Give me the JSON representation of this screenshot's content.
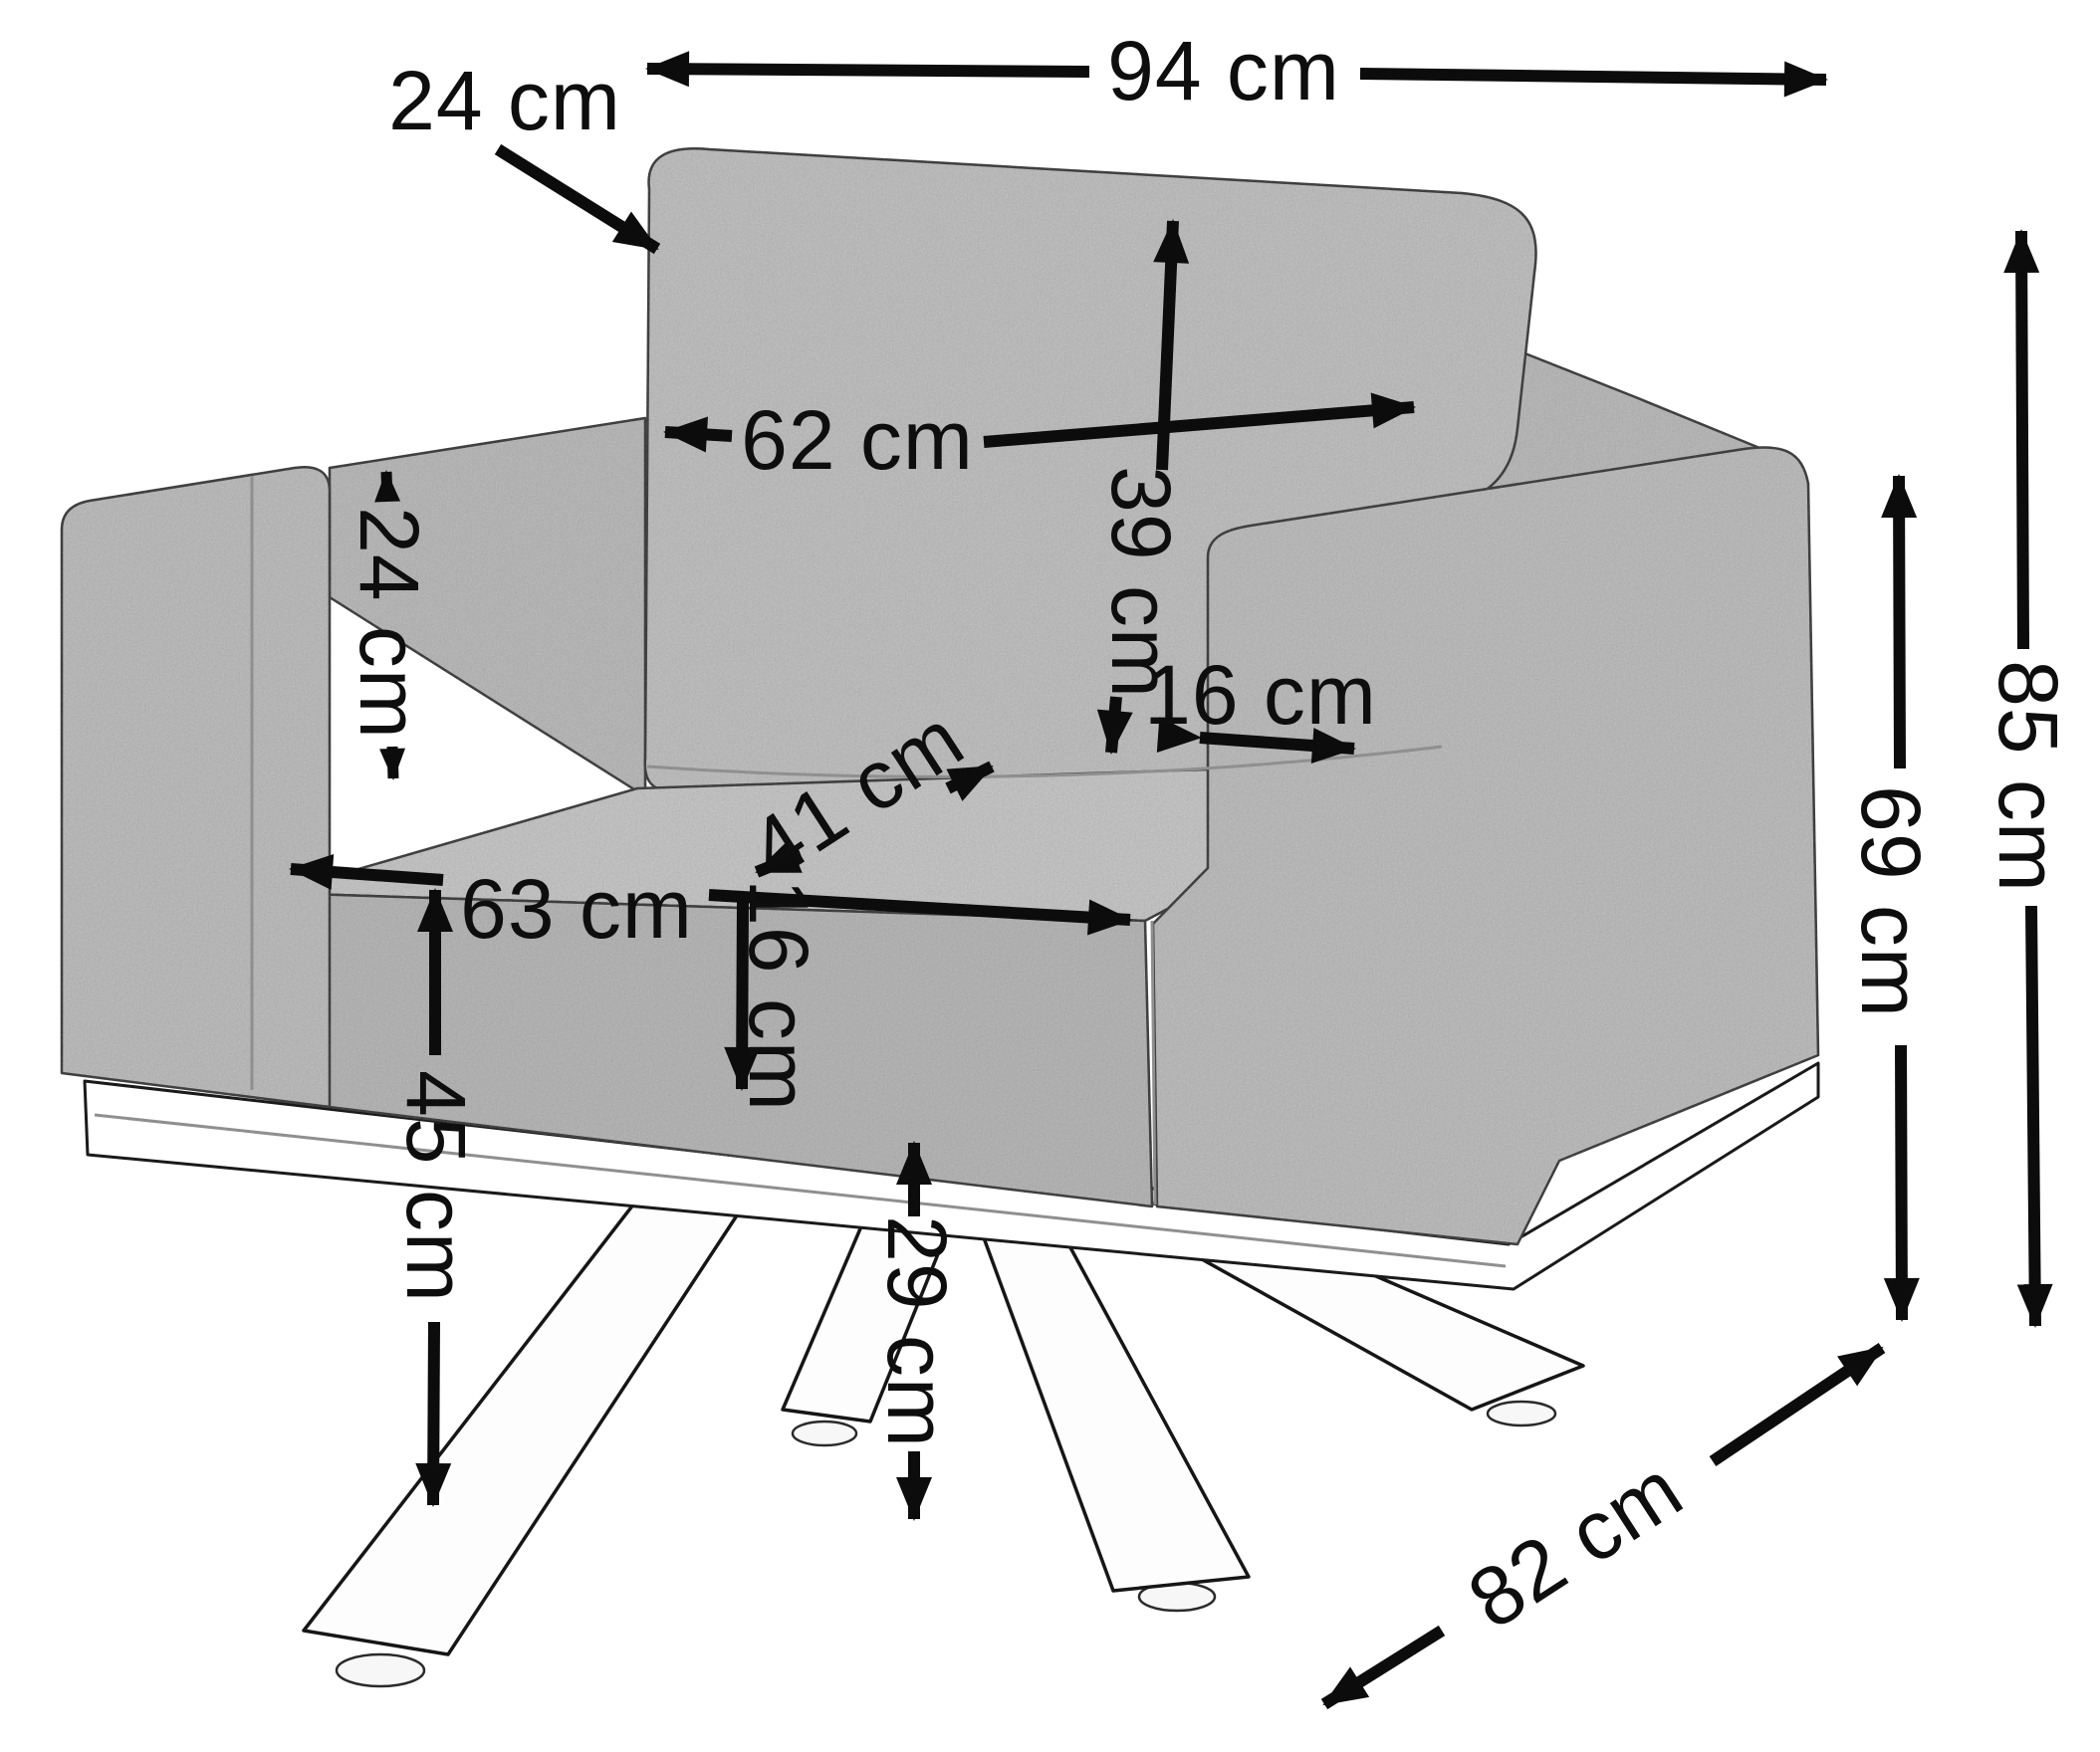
{
  "diagram": {
    "type": "furniture-dimension-diagram",
    "subject": "armchair with cushions on metal cross base",
    "unit": "cm",
    "ink_color": "#0c0c0c",
    "fabric_color": "#c3c3c3",
    "background_color": "#ffffff",
    "dims": {
      "overall_width": {
        "label": "94 cm",
        "value": 94,
        "orientation": "horizontal"
      },
      "back_cushion_thickness": {
        "label": "24 cm",
        "value": 24,
        "orientation": "diagonal-callout"
      },
      "back_cushion_width": {
        "label": "62 cm",
        "value": 62,
        "orientation": "horizontal"
      },
      "back_cushion_height": {
        "label": "39 cm",
        "value": 39,
        "orientation": "vertical"
      },
      "armrest_above_seat": {
        "label": "24 cm",
        "value": 24,
        "orientation": "vertical"
      },
      "armrest_width": {
        "label": "16 cm",
        "value": 16,
        "orientation": "horizontal"
      },
      "seat_depth": {
        "label": "41 cm",
        "value": 41,
        "orientation": "diagonal"
      },
      "seat_width": {
        "label": "63 cm",
        "value": 63,
        "orientation": "horizontal"
      },
      "seat_cushion_thickness": {
        "label": "16 cm",
        "value": 16,
        "orientation": "vertical"
      },
      "seat_height": {
        "label": "45 cm",
        "value": 45,
        "orientation": "vertical"
      },
      "base_clearance": {
        "label": "29 cm",
        "value": 29,
        "orientation": "vertical"
      },
      "armrest_height": {
        "label": "69 cm",
        "value": 69,
        "orientation": "vertical"
      },
      "overall_height": {
        "label": "85 cm",
        "value": 85,
        "orientation": "vertical"
      },
      "overall_depth": {
        "label": "82 cm",
        "value": 82,
        "orientation": "diagonal"
      }
    }
  }
}
